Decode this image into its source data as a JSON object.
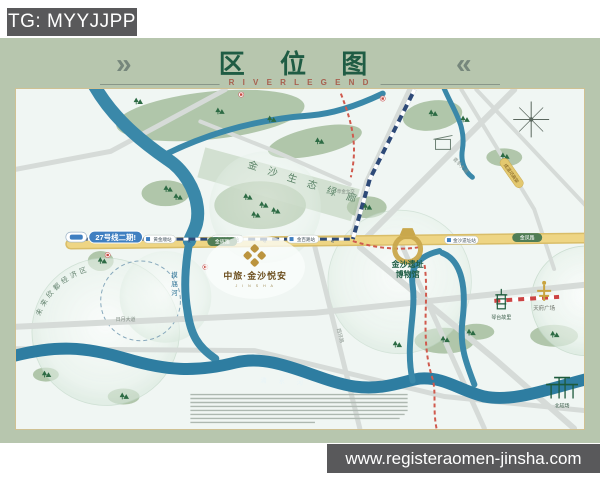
{
  "watermark": {
    "tg": "TG: MYYJJPP",
    "url": "www.registeraomen-jinsha.com"
  },
  "header": {
    "title": "区 位 图",
    "subtitle": "R I V E R  L E G E N D",
    "chevron_left": "»",
    "chevron_right": "«"
  },
  "map": {
    "project": {
      "name": "中旅·金沙悦安",
      "latin": "J I N S H A"
    },
    "metro_badge": "27号线二期!",
    "stations": [
      "黄金顺站",
      "黄金路站",
      "金百路站",
      "金沙遗址站"
    ],
    "roads": {
      "jinhui": "金辉路",
      "jinfeng": "金凤路",
      "riyue": "日月大道",
      "qingyang": "青羊大道",
      "xihuan": "西环路",
      "viaduct": "成温邛高架",
      "caojin": "草金立交"
    },
    "rivers": {
      "modi": [
        "摸",
        "底",
        "河"
      ],
      "qingshui": "清 水 河"
    },
    "zones": {
      "corridor": "金 沙 生 态 绿 廊",
      "economic": "未来欣都经济区"
    },
    "landmarks": {
      "museum_line1": "金沙遗址",
      "museum_line2": "博物馆",
      "tianfu": "天府广场",
      "qintai": "琴台故里",
      "beijiaochang": "北较场"
    },
    "colors": {
      "frame": "#b7c6ae",
      "title_green": "#1f5c44",
      "river": "#3a88a9",
      "road_gold": "#eed584",
      "metro_blue": "#3f7fc1",
      "rail_navy": "#2e4a78",
      "metro_red": "#d05a4e",
      "gold": "#c2a04c",
      "watermark_bg": "#59595b"
    }
  }
}
